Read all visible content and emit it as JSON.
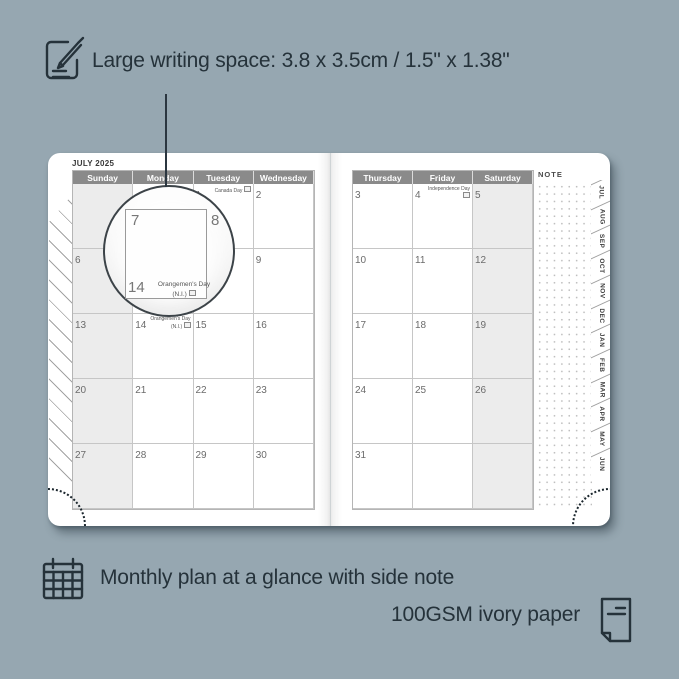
{
  "colors": {
    "background": "#96a7b1",
    "ink": "#25323a",
    "header_bg": "#8a8a8a",
    "shaded_column": "#ececec",
    "page": "#ffffff"
  },
  "top_caption": {
    "icon": "pencil-note-icon",
    "text": "Large writing space: 3.8 x 3.5cm / 1.5\" x 1.38\""
  },
  "bottom_caption": {
    "icon_left": "calendar-grid-icon",
    "line1": "Monthly plan at a glance with side note",
    "line2": "100GSM ivory paper",
    "icon_right": "paper-sheet-icon"
  },
  "planner": {
    "title": "JULY 2025",
    "note_label": "NOTE",
    "month_tabs": [
      "JUL",
      "AUG",
      "SEP",
      "OCT",
      "NOV",
      "DEC",
      "JAN",
      "FEB",
      "MAR",
      "APR",
      "MAY",
      "JUN"
    ],
    "left_page": {
      "day_headers": [
        "Sunday",
        "Monday",
        "Tuesday",
        "Wednesday"
      ],
      "shaded_column_index": 0,
      "weeks": [
        [
          {
            "date": ""
          },
          {
            "date": ""
          },
          {
            "date": "1",
            "holiday": "Canada Day"
          },
          {
            "date": "2"
          }
        ],
        [
          {
            "date": "6"
          },
          {
            "date": "7"
          },
          {
            "date": "8"
          },
          {
            "date": "9"
          }
        ],
        [
          {
            "date": "13"
          },
          {
            "date": "14",
            "holiday": "Orangemen's Day (N.I.)"
          },
          {
            "date": "15"
          },
          {
            "date": "16"
          }
        ],
        [
          {
            "date": "20"
          },
          {
            "date": "21"
          },
          {
            "date": "22"
          },
          {
            "date": "23"
          }
        ],
        [
          {
            "date": "27"
          },
          {
            "date": "28"
          },
          {
            "date": "29"
          },
          {
            "date": "30"
          }
        ]
      ]
    },
    "right_page": {
      "day_headers": [
        "Thursday",
        "Friday",
        "Saturday"
      ],
      "shaded_column_index": 2,
      "weeks": [
        [
          {
            "date": "3"
          },
          {
            "date": "4",
            "holiday": "Independence Day"
          },
          {
            "date": "5"
          }
        ],
        [
          {
            "date": "10"
          },
          {
            "date": "11"
          },
          {
            "date": "12"
          }
        ],
        [
          {
            "date": "17"
          },
          {
            "date": "18"
          },
          {
            "date": "19"
          }
        ],
        [
          {
            "date": "24"
          },
          {
            "date": "25"
          },
          {
            "date": "26"
          }
        ],
        [
          {
            "date": "31"
          },
          {
            "date": ""
          },
          {
            "date": ""
          }
        ]
      ]
    }
  },
  "magnifier": {
    "day_left": "7",
    "day_right": "8",
    "day_bottom": "14",
    "holiday_name": "Orangemen's Day",
    "holiday_region": "(N.I.)"
  }
}
